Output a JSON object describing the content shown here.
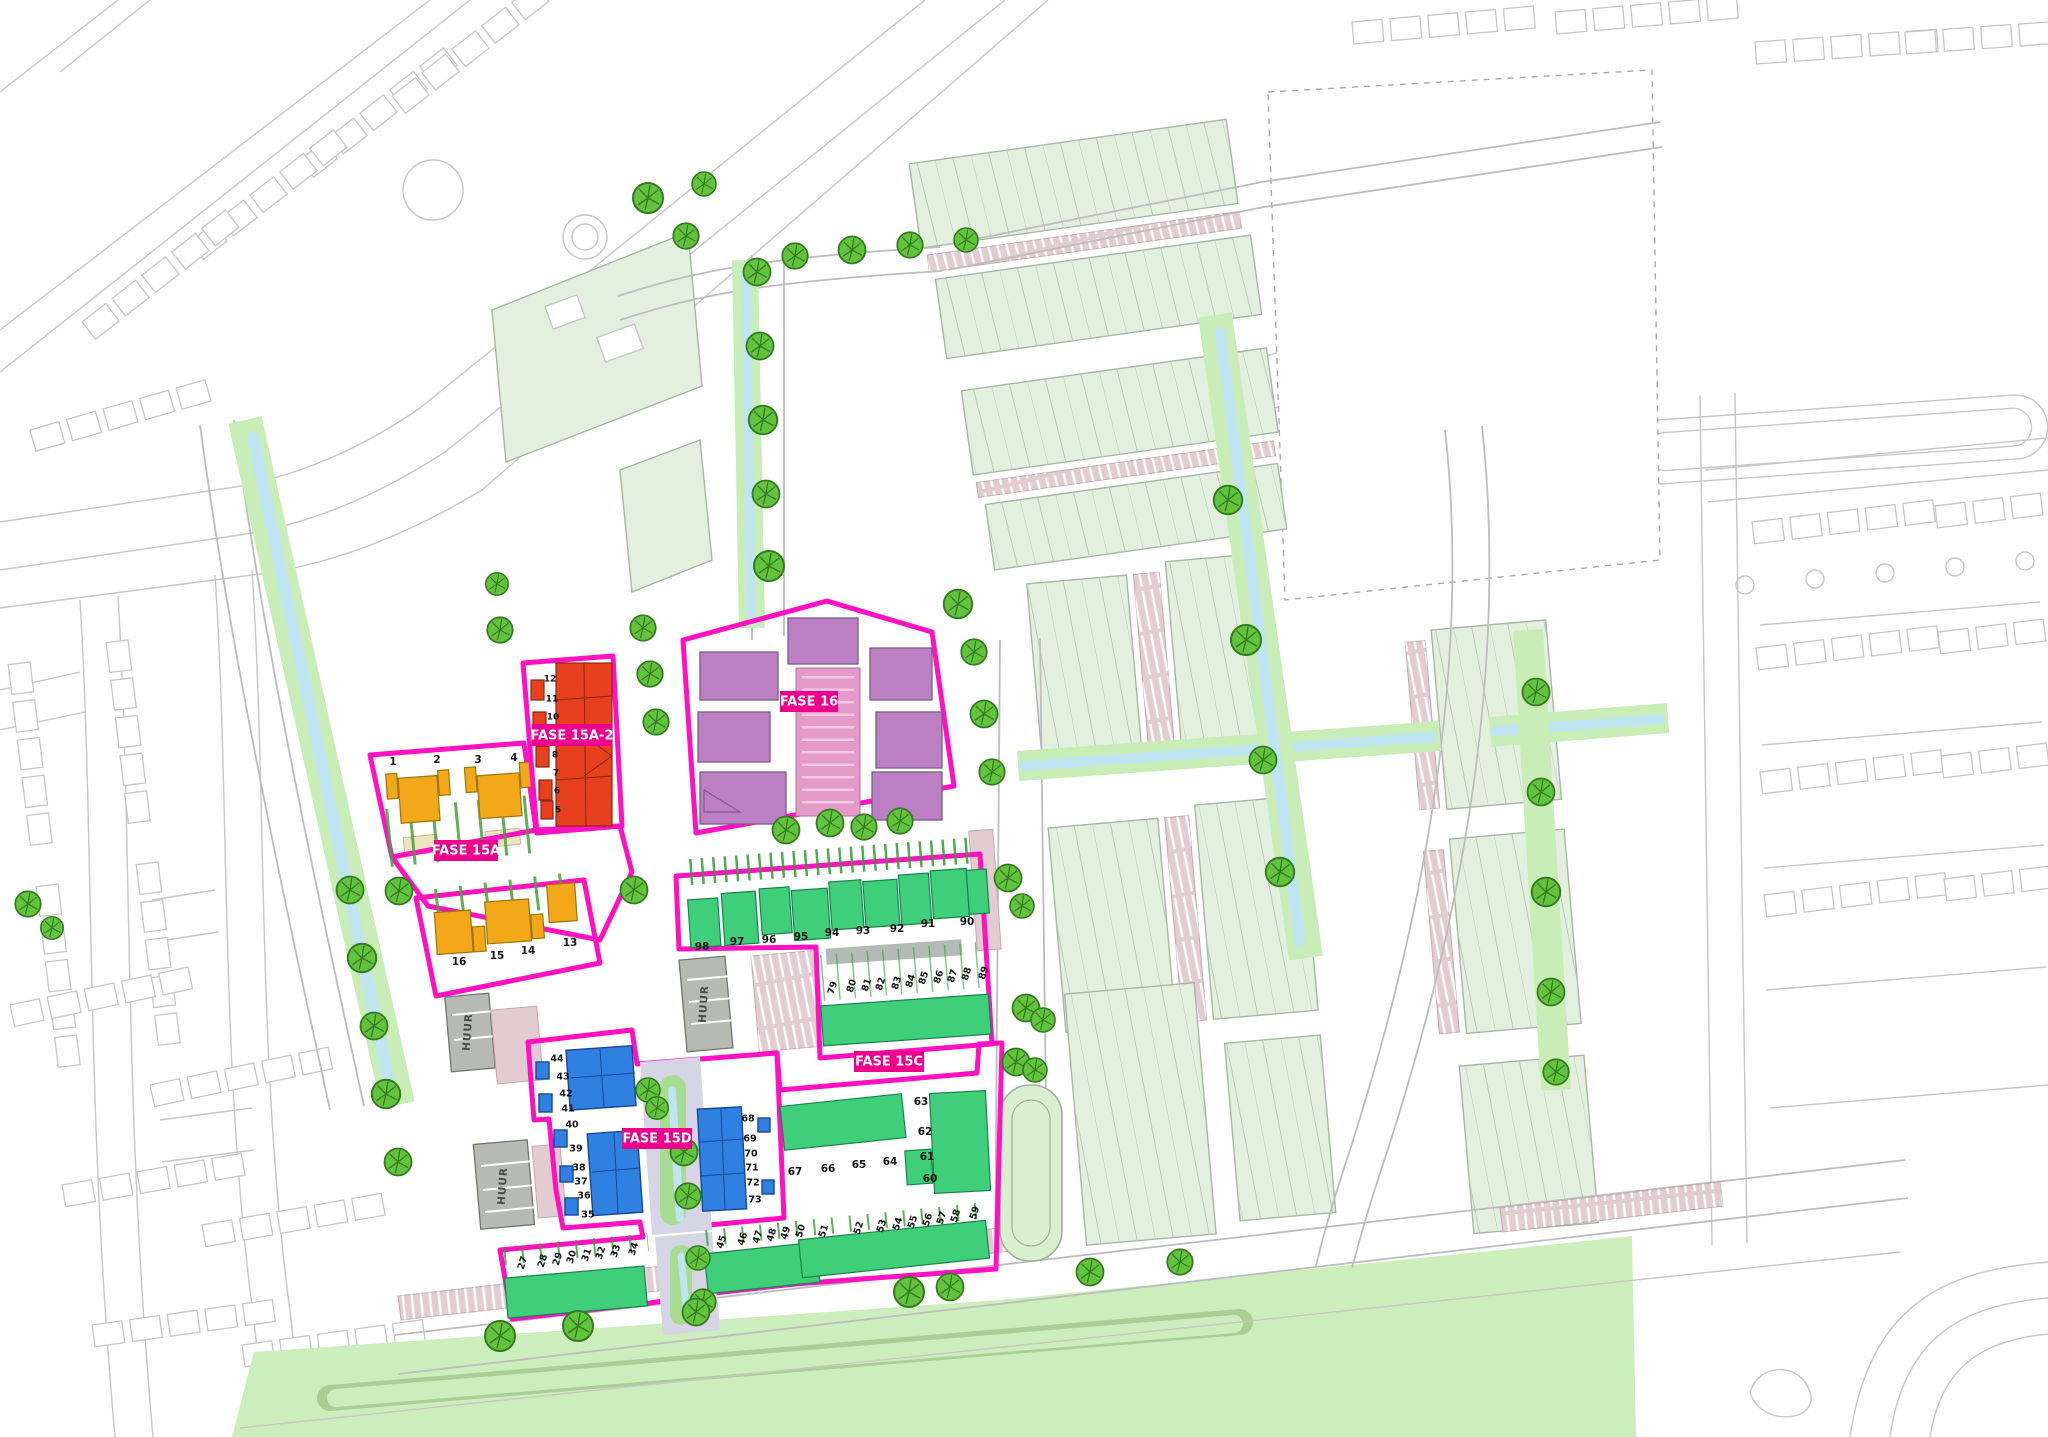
{
  "phases": {
    "fase15a": {
      "label": "FASE 15A",
      "lots_north": [
        "1",
        "2",
        "3",
        "4"
      ],
      "lots_south": [
        "16",
        "15",
        "14",
        "13"
      ],
      "lot_color": "#7ccb3a",
      "house_color": "#f2a818"
    },
    "fase15a2": {
      "label": "FASE 15A-2",
      "lots": [
        "12",
        "11",
        "10",
        "8",
        "7",
        "6",
        "5"
      ],
      "lot_color": "#93a24b",
      "house_color": "#e6401f"
    },
    "fase16": {
      "label": "FASE 16",
      "area_color": "#c487c9",
      "parking_color": "#e59bc8"
    },
    "fase15c": {
      "label": "FASE 15C",
      "lots_row_north": [
        "98",
        "97",
        "96",
        "95",
        "94",
        "93",
        "92",
        "91",
        "90"
      ],
      "lots_row_mid": [
        "79",
        "80",
        "81",
        "82",
        "83",
        "84",
        "85",
        "86",
        "87",
        "88",
        "89"
      ],
      "lots_row_south_upper": [
        "67",
        "66",
        "65",
        "64",
        "60",
        "61",
        "62",
        "63"
      ],
      "lots_row_45_50": [
        "45",
        "46",
        "47",
        "48",
        "49",
        "50"
      ],
      "lots_row_51_59": [
        "51",
        "52",
        "53",
        "54",
        "55",
        "56",
        "57",
        "58",
        "59"
      ],
      "lots_row_27_34": [
        "27",
        "28",
        "29",
        "30",
        "31",
        "32",
        "33",
        "34"
      ],
      "lot_color": "#5cd843",
      "house_color": "#3fcf7b"
    },
    "fase15d": {
      "label": "FASE 15D",
      "lots_west": [
        "44",
        "43",
        "42",
        "41",
        "40",
        "39",
        "38",
        "37",
        "36",
        "35"
      ],
      "lots_east": [
        "68",
        "69",
        "70",
        "71",
        "72",
        "73"
      ],
      "house_color": "#2f80e0"
    }
  },
  "rental_building_label": "HUUR",
  "colors": {
    "phase_outline": "#ff10c0",
    "label_background": "#ec008c",
    "label_text": "#ffffff",
    "water": "#bfe4f2",
    "water_bank": "#c9edb7",
    "tree": "#63c23e",
    "context_block": "#e4f0df",
    "parking_strip": "#e3ccd1",
    "rental_building": "#b6bab2",
    "green_belt": "#cceebc",
    "tan_road": "#e9d9ae"
  }
}
